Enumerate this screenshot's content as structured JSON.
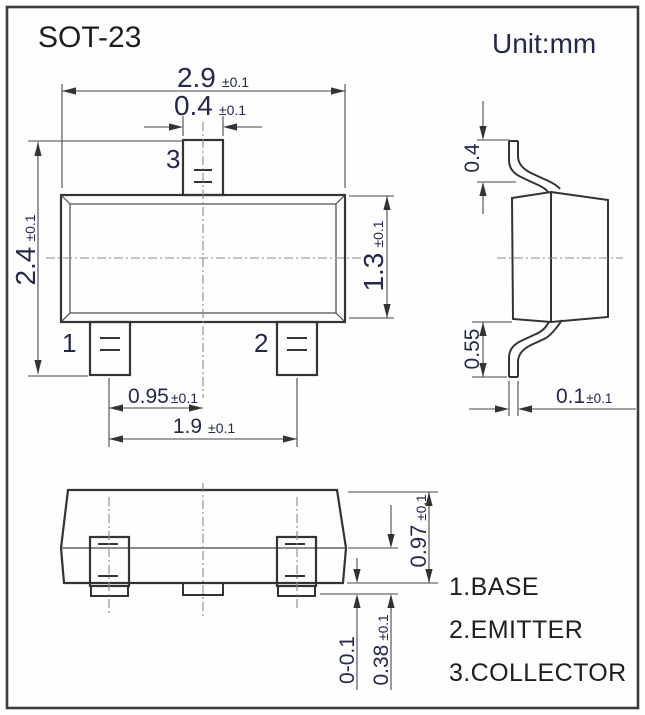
{
  "header": {
    "title": "SOT-23",
    "unit": "Unit:mm"
  },
  "colors": {
    "line": "#333333",
    "dimension_text": "#24294c",
    "label_text": "#1e1e1e"
  },
  "top_view": {
    "pin1_label": "1",
    "pin2_label": "2",
    "pin3_label": "3",
    "dim_body_width": {
      "value": "2.9",
      "tol": "±0.1"
    },
    "dim_pin3_width": {
      "value": "0.4",
      "tol": "±0.1"
    },
    "dim_overall_length": {
      "value": "2.4",
      "tol": "±0.1"
    },
    "dim_body_length": {
      "value": "1.3",
      "tol": "±0.1"
    },
    "dim_pin_half_pitch": {
      "value": "0.95",
      "tol": "±0.1"
    },
    "dim_pin_pitch": {
      "value": "1.9",
      "tol": "±0.1"
    }
  },
  "side_view": {
    "dim_lead_top": "0.4",
    "dim_lead_bottom": "0.55",
    "dim_lead_tip": {
      "value": "0.1",
      "tol": "±0.1"
    }
  },
  "front_view": {
    "dim_height": {
      "value": "0.97",
      "tol": "±0.1"
    },
    "dim_standoff": "0-0.1",
    "dim_lead_length": {
      "value": "0.38",
      "tol": "±0.1"
    }
  },
  "legend": {
    "pin1": "1.BASE",
    "pin2": "2.EMITTER",
    "pin3": "3.COLLECTOR"
  }
}
